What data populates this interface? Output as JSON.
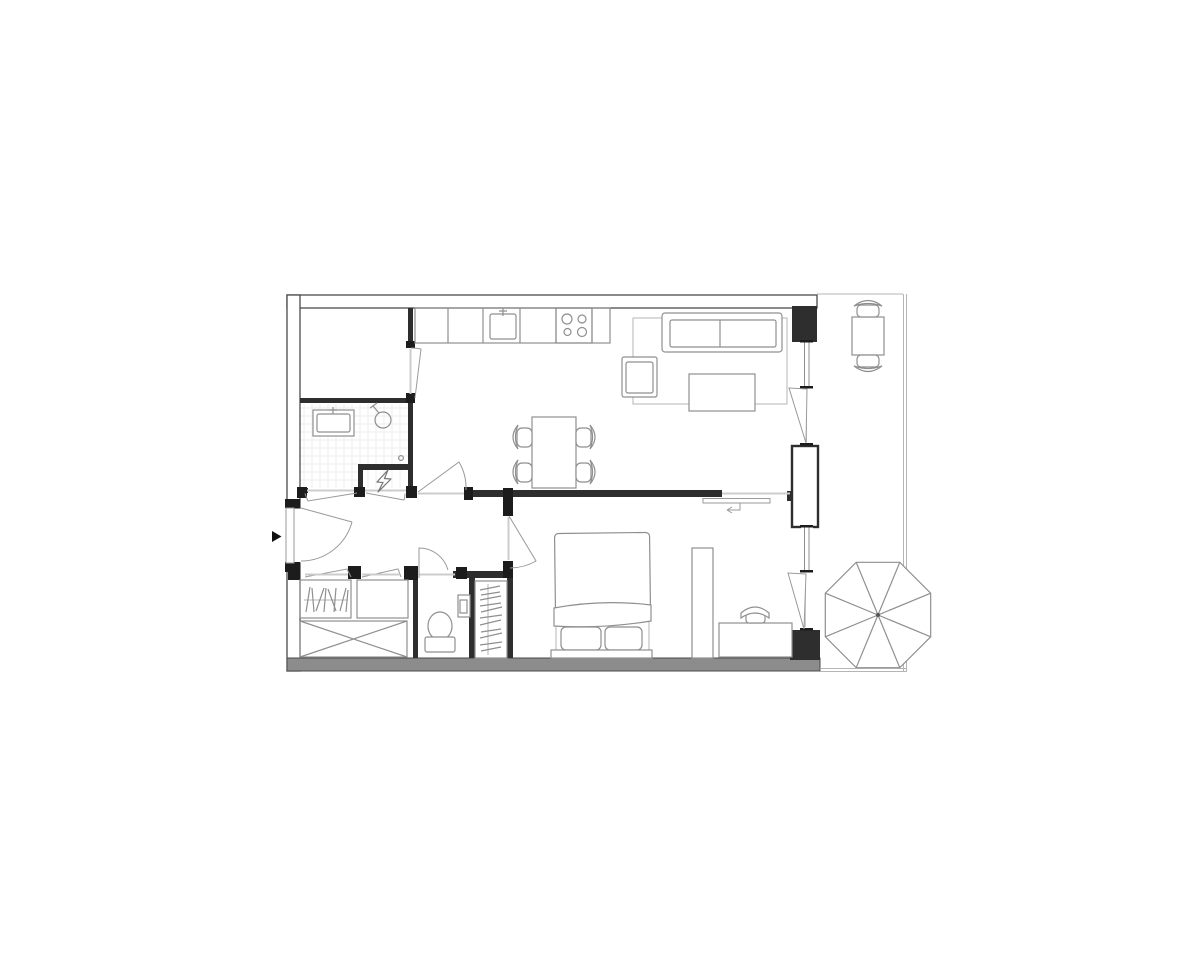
{
  "document": {
    "kind": "apartment floor plan drawing",
    "background": "#ffffff"
  },
  "colors": {
    "page_bg": "#ffffff",
    "wall_stroke": "#4a4a4a",
    "wall_fill": "#ffffff",
    "wall_solid": "#2e2e2e",
    "wall_gray": "#8c8c8c",
    "jamb": "#1c1c1c",
    "furniture": "#8f8f8f",
    "furniture_light": "#b5b5b5",
    "door": "#9a9a9a",
    "threshold": "#cccccc",
    "tile": "#e9e9e9",
    "accent": "#111111"
  },
  "plan": {
    "rooms": [
      {
        "name": "storage-room",
        "fixtures": []
      },
      {
        "name": "bathroom",
        "fixtures": [
          "washbasin",
          "shower-head",
          "tiled-floor",
          "door-knob"
        ]
      },
      {
        "name": "electrical-closet",
        "fixtures": [
          "electrical-panel-lightning-bolt"
        ]
      },
      {
        "name": "kitchen",
        "fixtures": [
          "counter-run",
          "kitchen-sink",
          "cooktop-4-burners"
        ]
      },
      {
        "name": "living-dining-room",
        "fixtures": [
          "dining-table",
          "four-dining-chairs",
          "rug",
          "sofa",
          "armchair",
          "coffee-table",
          "sliding-partition-door"
        ]
      },
      {
        "name": "entry-hall",
        "fixtures": [
          "entrance-door",
          "hanging-rail-wardrobe",
          "closet-box",
          "crossed-shaft-box"
        ]
      },
      {
        "name": "wc",
        "fixtures": [
          "toilet",
          "small-washbasin"
        ]
      },
      {
        "name": "bedroom",
        "fixtures": [
          "double-bed",
          "two-pillows",
          "wardrobe-column",
          "hanging-rail-closet",
          "desk",
          "desk-chair"
        ]
      },
      {
        "name": "balcony",
        "fixtures": [
          "bistro-table",
          "two-balcony-chairs",
          "parasol"
        ]
      }
    ],
    "annotations": {
      "entrance_marker": "solid triangle arrow pointing at entrance door",
      "sliding_door_marker": "return arrow showing slide direction of partition panel"
    }
  }
}
